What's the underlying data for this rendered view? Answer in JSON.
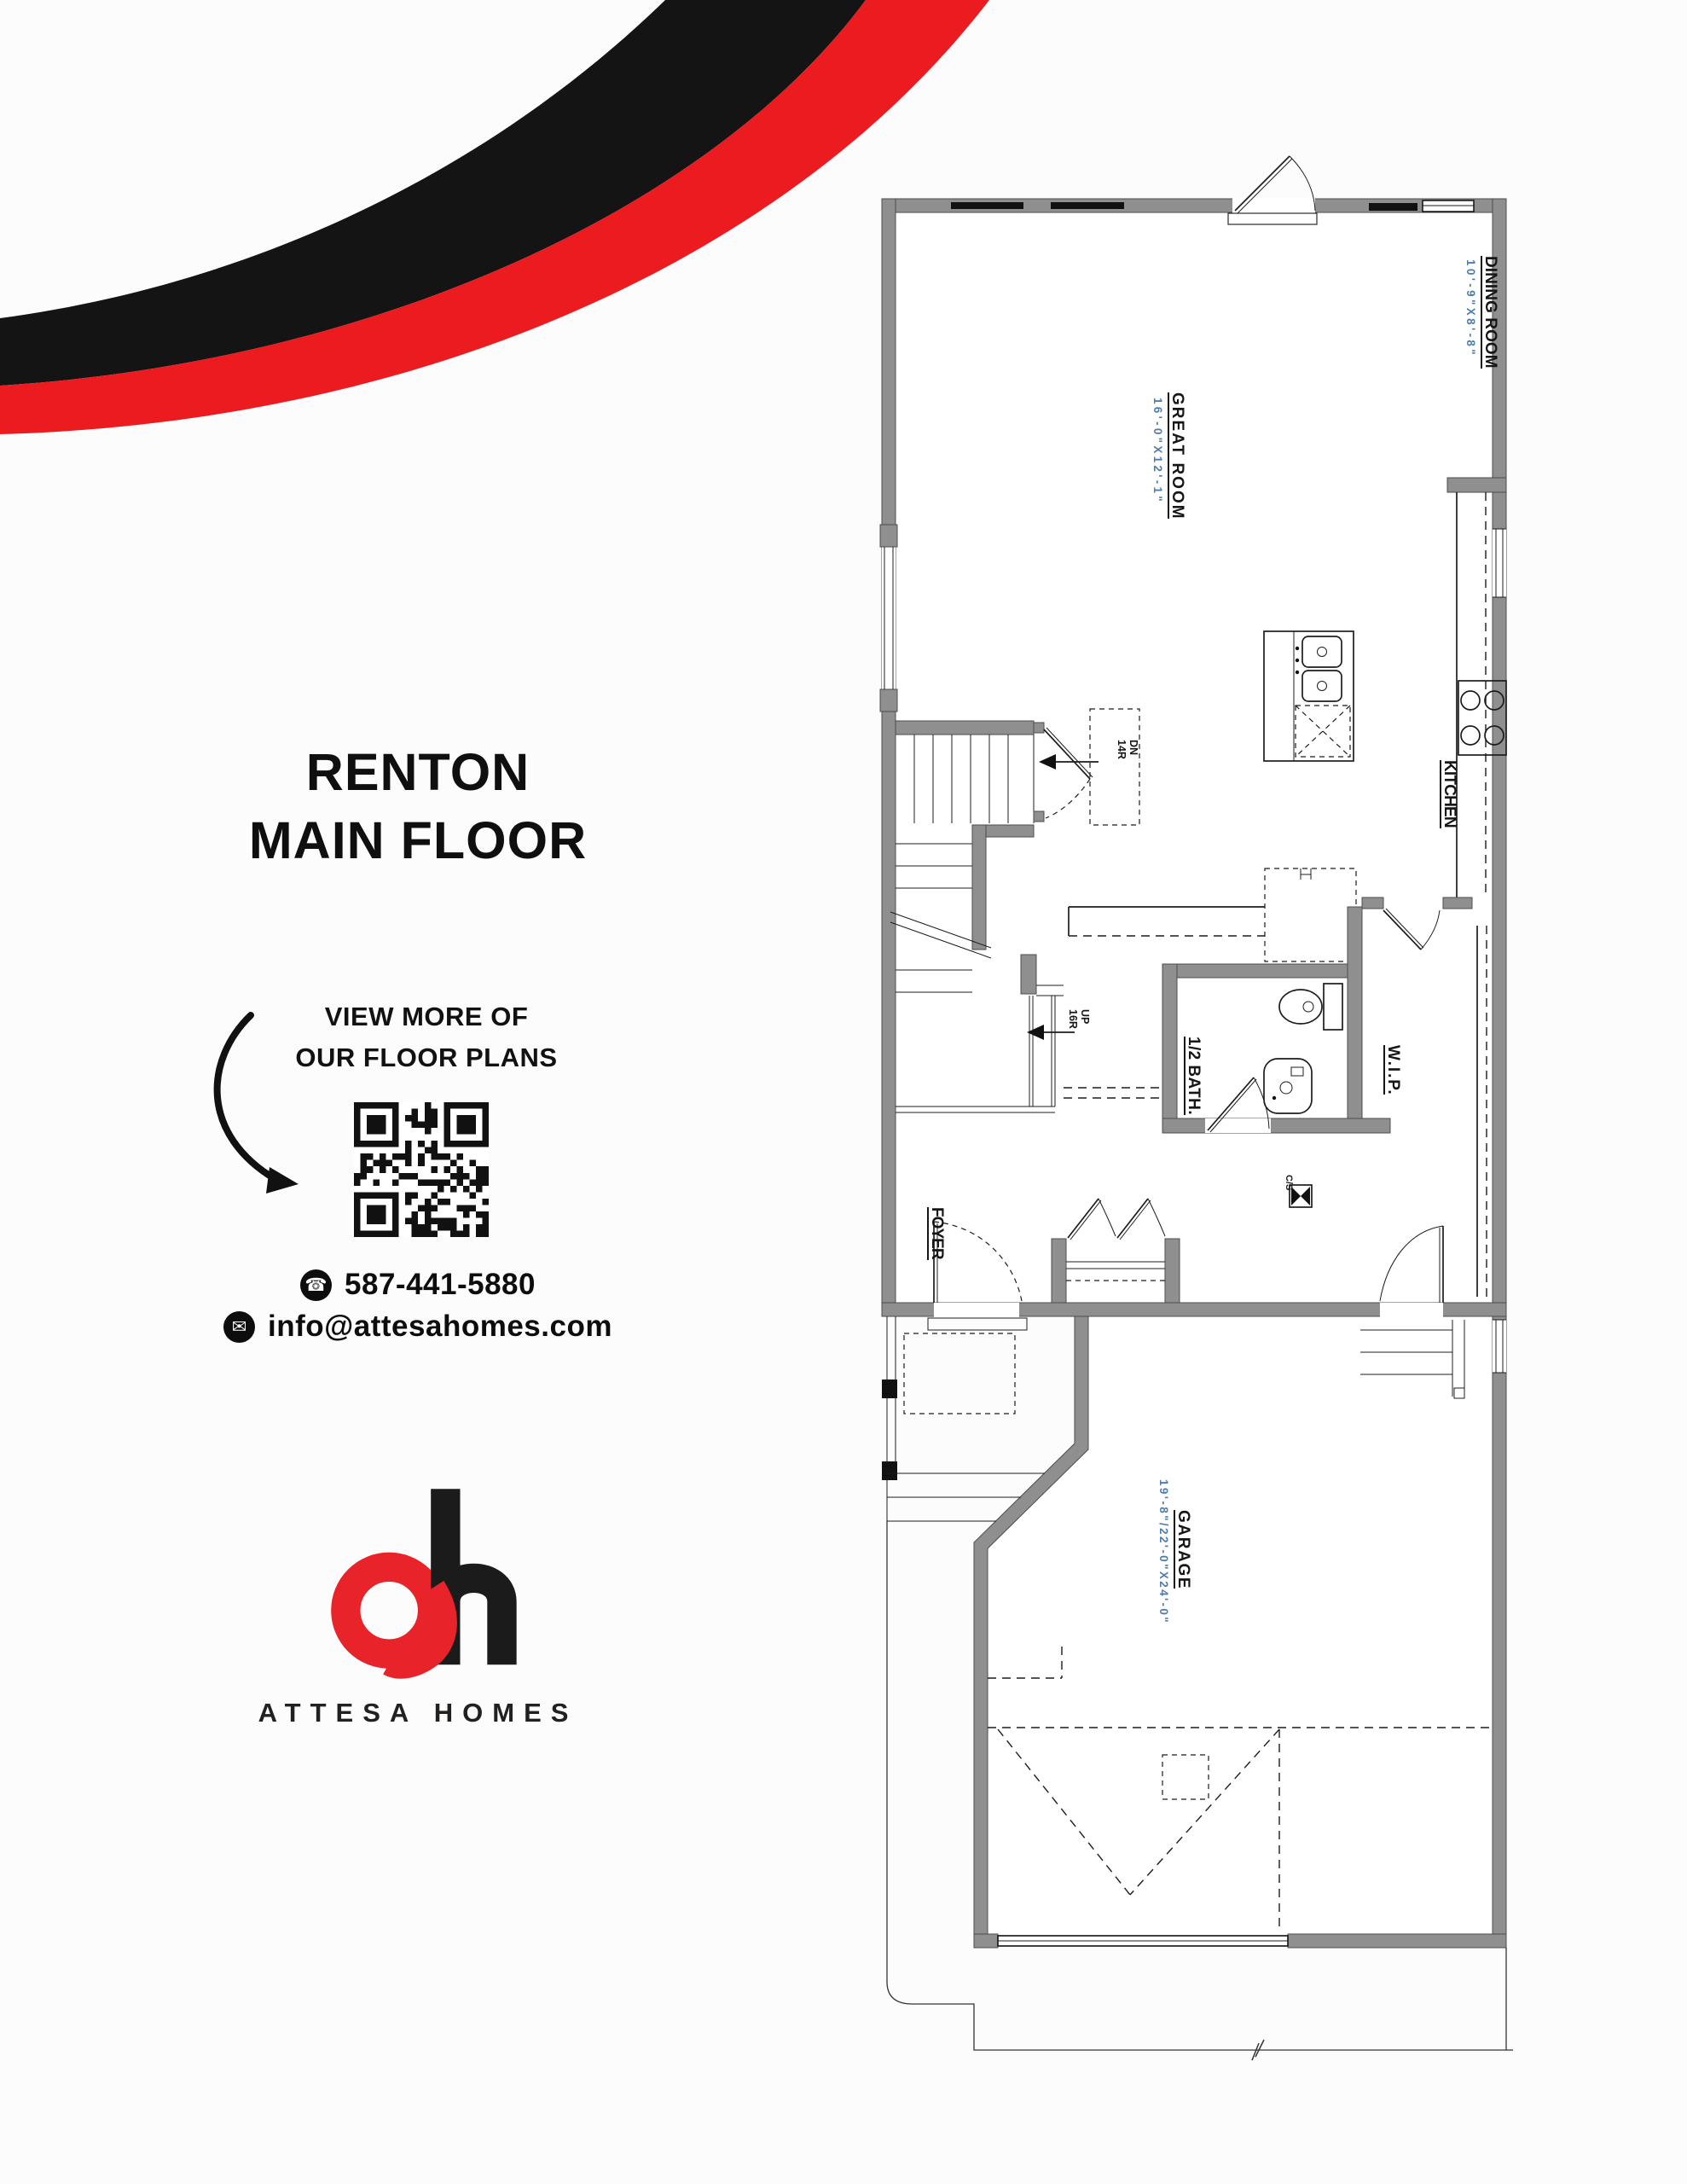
{
  "page": {
    "background": "#fcfcfc"
  },
  "branding": {
    "company_name": "ATTESA HOMES",
    "accent_red": "#e8232a",
    "accent_black": "#161616"
  },
  "sidebar": {
    "title_line1": "RENTON",
    "title_line2": "MAIN FLOOR",
    "cta_line1": "VIEW MORE OF",
    "cta_line2": "OUR FLOOR PLANS",
    "contacts": [
      {
        "icon": "phone-icon",
        "value": "587-441-5880"
      },
      {
        "icon": "email-icon",
        "value": "info@attesahomes.com"
      }
    ]
  },
  "floor_plan": {
    "dimension_color": "#4f7dab",
    "rooms": [
      {
        "name": "DINING ROOM",
        "dimensions": "10'-9\"X8'-8\""
      },
      {
        "name": "GREAT ROOM",
        "dimensions": "16'-0\"X12'-1\""
      },
      {
        "name": "KITCHEN",
        "dimensions": ""
      },
      {
        "name": "1/2 BATH.",
        "dimensions": ""
      },
      {
        "name": "W.I.P.",
        "dimensions": ""
      },
      {
        "name": "FOYER",
        "dimensions": ""
      },
      {
        "name": "GARAGE",
        "dimensions": "19'-8\"/22'-0\"X24'-0\""
      }
    ],
    "stairs": [
      {
        "label": "DN",
        "risers": "14R"
      },
      {
        "label": "UP",
        "risers": "16R"
      }
    ],
    "annotations": [
      {
        "label": "C/S"
      }
    ]
  }
}
